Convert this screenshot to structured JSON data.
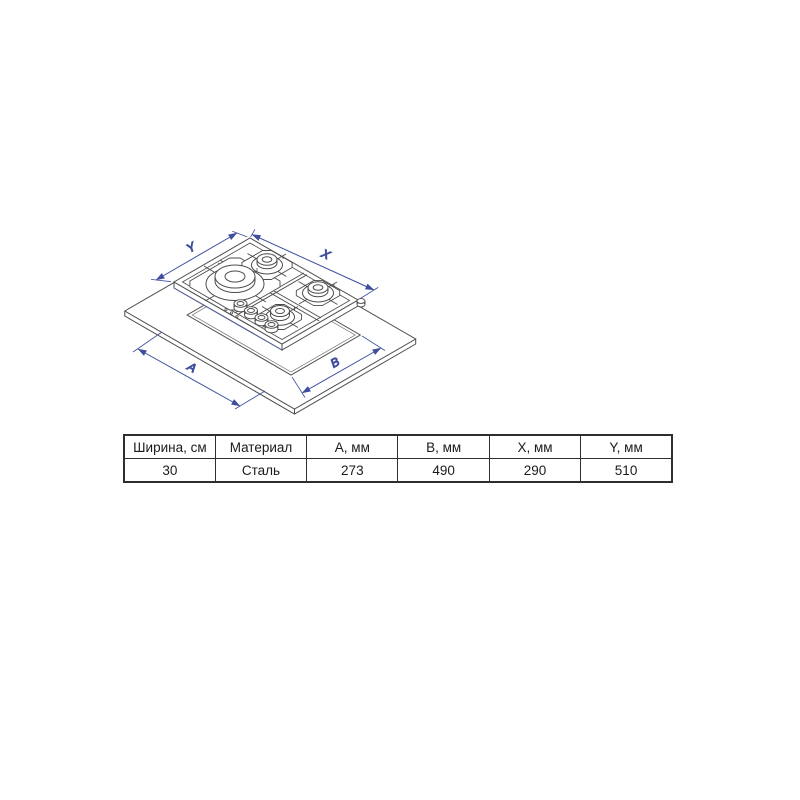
{
  "page": {
    "background": "#ffffff"
  },
  "diagram": {
    "dimension_labels": {
      "y": "Y",
      "x": "X",
      "a": "A",
      "b": "B"
    },
    "colors": {
      "dimension_blue": "#3e4e9d",
      "line_gray": "#4c4c4c"
    }
  },
  "spec_table": {
    "columns": [
      {
        "header": "Ширина, см",
        "value": "30"
      },
      {
        "header": "Материал",
        "value": "Сталь"
      },
      {
        "header": "A, мм",
        "value": "273"
      },
      {
        "header": "B, мм",
        "value": "490"
      },
      {
        "header": "X, мм",
        "value": "290"
      },
      {
        "header": "Y, мм",
        "value": "510"
      }
    ]
  }
}
